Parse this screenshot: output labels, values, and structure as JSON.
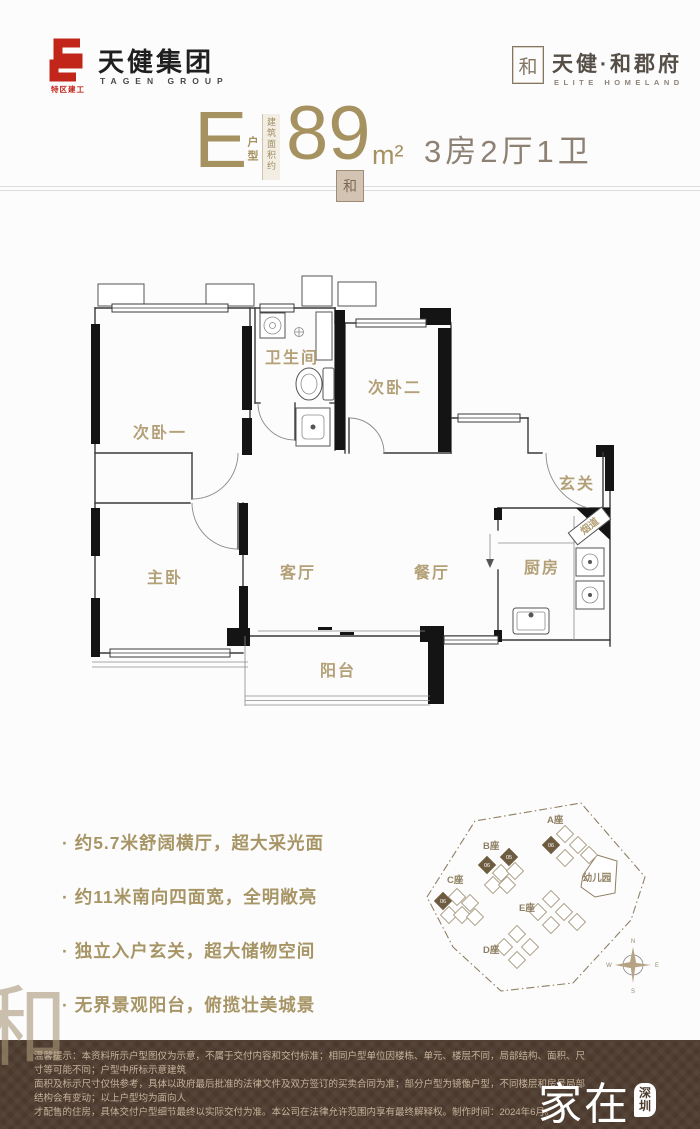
{
  "header": {
    "tagen_sub": "特区建工",
    "tagen_name": "天健集团",
    "tagen_en": "TAGEN GROUP",
    "brand_seal": "和",
    "brand_name": "天健·和郡府",
    "brand_en": "ELITE HOMELAND"
  },
  "title": {
    "unit_letter": "E",
    "unit_type_label": "户型",
    "area_prefix": "建筑面积约",
    "area_value": "89",
    "area_unit": "m²",
    "room_config": "3房2厅1卫",
    "divider_seal": "和"
  },
  "floorplan": {
    "rooms": {
      "bedroom_1": "次卧一",
      "bathroom": "卫生间",
      "bedroom_2": "次卧二",
      "foyer": "玄关",
      "master_bedroom": "主卧",
      "living_room": "客厅",
      "dining_room": "餐厅",
      "kitchen": "厨房",
      "flue": "烟道",
      "balcony": "阳台"
    }
  },
  "features": [
    "约5.7米舒阔横厅，超大采光面",
    "约11米南向四面宽，全明敞亮",
    "独立入户玄关，超大储物空间",
    "无界景观阳台，俯揽壮美城景"
  ],
  "siteplan": {
    "block_a": "A座",
    "block_b": "B座",
    "block_c": "C座",
    "block_d": "D座",
    "block_e": "E座",
    "kindergarten": "幼儿园",
    "units": {
      "a1": "06",
      "b1": "06",
      "b2": "05",
      "c1": "06"
    },
    "compass": {
      "n": "N",
      "e": "E",
      "s": "S",
      "w": "W"
    }
  },
  "watermark_glyph": "和",
  "footer": {
    "lines": [
      "温馨提示：本资料所示户型图仅为示意，不属于交付内容和交付标准；相同户型单位因楼栋、单元、楼层不同，局部结构、面积、尺寸等可能不同；户型中所标示意建筑",
      "面积及标示尺寸仅供参考，具体以政府最后批准的法律文件及双方签订的买卖合同为准；部分户型为镜像户型，不同楼层和房号局部结构会有变动；以上户型均为面向人",
      "才配售的住房，具体交付户型细节最终以实际交付为准。本公司在法律允许范围内享有最终解释权。制作时间：2024年6月。"
    ],
    "wm_main": "家在",
    "wm_city": "深圳",
    "wm_site": "bbs.szhome.com"
  },
  "colors": {
    "accent_gold": "#a69160",
    "room_label": "#b3a077",
    "logo_red": "#c2261a",
    "footer_bg": "#4a392c",
    "footer_text": "#c6b29a"
  }
}
